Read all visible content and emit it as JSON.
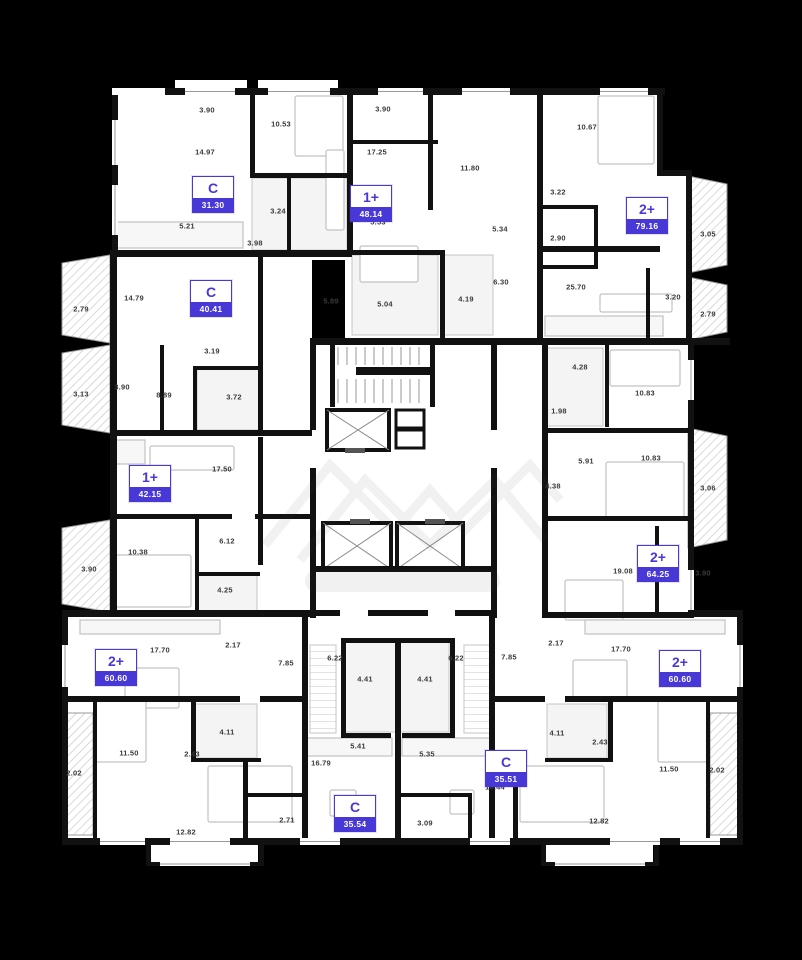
{
  "plan": {
    "name": "residential-floor-plan",
    "colors": {
      "background": "#000000",
      "walls": "#111111",
      "floor": "#ffffff",
      "accent": "#4838d6",
      "label_text": "#3a3a3a"
    }
  },
  "apartments": [
    {
      "type": "C",
      "area": "31.30"
    },
    {
      "type": "1+",
      "area": "48.14"
    },
    {
      "type": "2+",
      "area": "79.16"
    },
    {
      "type": "C",
      "area": "40.41"
    },
    {
      "type": "1+",
      "area": "42.15"
    },
    {
      "type": "2+",
      "area": "64.25"
    },
    {
      "type": "2+",
      "area": "60.60"
    },
    {
      "type": "2+",
      "area": "60.60"
    },
    {
      "type": "C",
      "area": "35.54"
    },
    {
      "type": "C",
      "area": "35.51"
    }
  ],
  "room_labels": [
    {
      "t": "3.90",
      "x": 207,
      "y": 110
    },
    {
      "t": "14.97",
      "x": 205,
      "y": 152
    },
    {
      "t": "10.53",
      "x": 281,
      "y": 124
    },
    {
      "t": "5.21",
      "x": 187,
      "y": 226
    },
    {
      "t": "3.24",
      "x": 278,
      "y": 211
    },
    {
      "t": "3.98",
      "x": 255,
      "y": 243
    },
    {
      "t": "3.90",
      "x": 383,
      "y": 109
    },
    {
      "t": "17.25",
      "x": 377,
      "y": 152
    },
    {
      "t": "11.80",
      "x": 470,
      "y": 168
    },
    {
      "t": "5.53",
      "x": 378,
      "y": 222
    },
    {
      "t": "5.34",
      "x": 500,
      "y": 229
    },
    {
      "t": "6.30",
      "x": 501,
      "y": 282
    },
    {
      "t": "5.04",
      "x": 385,
      "y": 304
    },
    {
      "t": "4.19",
      "x": 466,
      "y": 299
    },
    {
      "t": "5.89",
      "x": 331,
      "y": 301
    },
    {
      "t": "10.67",
      "x": 587,
      "y": 127
    },
    {
      "t": "3.22",
      "x": 558,
      "y": 192
    },
    {
      "t": "2.90",
      "x": 558,
      "y": 238
    },
    {
      "t": "3.05",
      "x": 708,
      "y": 234
    },
    {
      "t": "25.70",
      "x": 576,
      "y": 287
    },
    {
      "t": "3.20",
      "x": 673,
      "y": 297
    },
    {
      "t": "2.79",
      "x": 708,
      "y": 314
    },
    {
      "t": "2.79",
      "x": 81,
      "y": 309
    },
    {
      "t": "14.79",
      "x": 134,
      "y": 298
    },
    {
      "t": "3.13",
      "x": 81,
      "y": 394
    },
    {
      "t": "3.90",
      "x": 122,
      "y": 387
    },
    {
      "t": "8.89",
      "x": 164,
      "y": 395
    },
    {
      "t": "3.19",
      "x": 212,
      "y": 351
    },
    {
      "t": "3.72",
      "x": 234,
      "y": 397
    },
    {
      "t": "17.50",
      "x": 222,
      "y": 469
    },
    {
      "t": "10.38",
      "x": 138,
      "y": 552
    },
    {
      "t": "3.90",
      "x": 89,
      "y": 569
    },
    {
      "t": "6.12",
      "x": 227,
      "y": 541
    },
    {
      "t": "4.25",
      "x": 225,
      "y": 590
    },
    {
      "t": "4.28",
      "x": 580,
      "y": 367
    },
    {
      "t": "10.83",
      "x": 645,
      "y": 393
    },
    {
      "t": "1.98",
      "x": 559,
      "y": 411
    },
    {
      "t": "5.91",
      "x": 586,
      "y": 461
    },
    {
      "t": "10.83",
      "x": 651,
      "y": 458
    },
    {
      "t": "4.38",
      "x": 553,
      "y": 486
    },
    {
      "t": "3.06",
      "x": 708,
      "y": 488
    },
    {
      "t": "19.08",
      "x": 623,
      "y": 571
    },
    {
      "t": "3.90",
      "x": 703,
      "y": 573
    },
    {
      "t": "17.70",
      "x": 160,
      "y": 650
    },
    {
      "t": "2.17",
      "x": 233,
      "y": 645
    },
    {
      "t": "7.85",
      "x": 286,
      "y": 663
    },
    {
      "t": "4.11",
      "x": 227,
      "y": 732
    },
    {
      "t": "2.43",
      "x": 192,
      "y": 754
    },
    {
      "t": "11.50",
      "x": 129,
      "y": 753
    },
    {
      "t": "2.02",
      "x": 74,
      "y": 773
    },
    {
      "t": "12.82",
      "x": 186,
      "y": 832
    },
    {
      "t": "17.70",
      "x": 621,
      "y": 649
    },
    {
      "t": "2.17",
      "x": 556,
      "y": 643
    },
    {
      "t": "7.85",
      "x": 509,
      "y": 657
    },
    {
      "t": "4.11",
      "x": 557,
      "y": 733
    },
    {
      "t": "2.43",
      "x": 600,
      "y": 742
    },
    {
      "t": "11.50",
      "x": 669,
      "y": 769
    },
    {
      "t": "2.02",
      "x": 717,
      "y": 770
    },
    {
      "t": "12.82",
      "x": 599,
      "y": 821
    },
    {
      "t": "6.22",
      "x": 335,
      "y": 658
    },
    {
      "t": "4.41",
      "x": 365,
      "y": 679
    },
    {
      "t": "5.41",
      "x": 358,
      "y": 746
    },
    {
      "t": "16.79",
      "x": 321,
      "y": 763
    },
    {
      "t": "2.71",
      "x": 287,
      "y": 820
    },
    {
      "t": "6.22",
      "x": 456,
      "y": 658
    },
    {
      "t": "4.41",
      "x": 425,
      "y": 679
    },
    {
      "t": "5.35",
      "x": 427,
      "y": 754
    },
    {
      "t": "16.44",
      "x": 495,
      "y": 787
    },
    {
      "t": "3.09",
      "x": 425,
      "y": 823
    }
  ]
}
